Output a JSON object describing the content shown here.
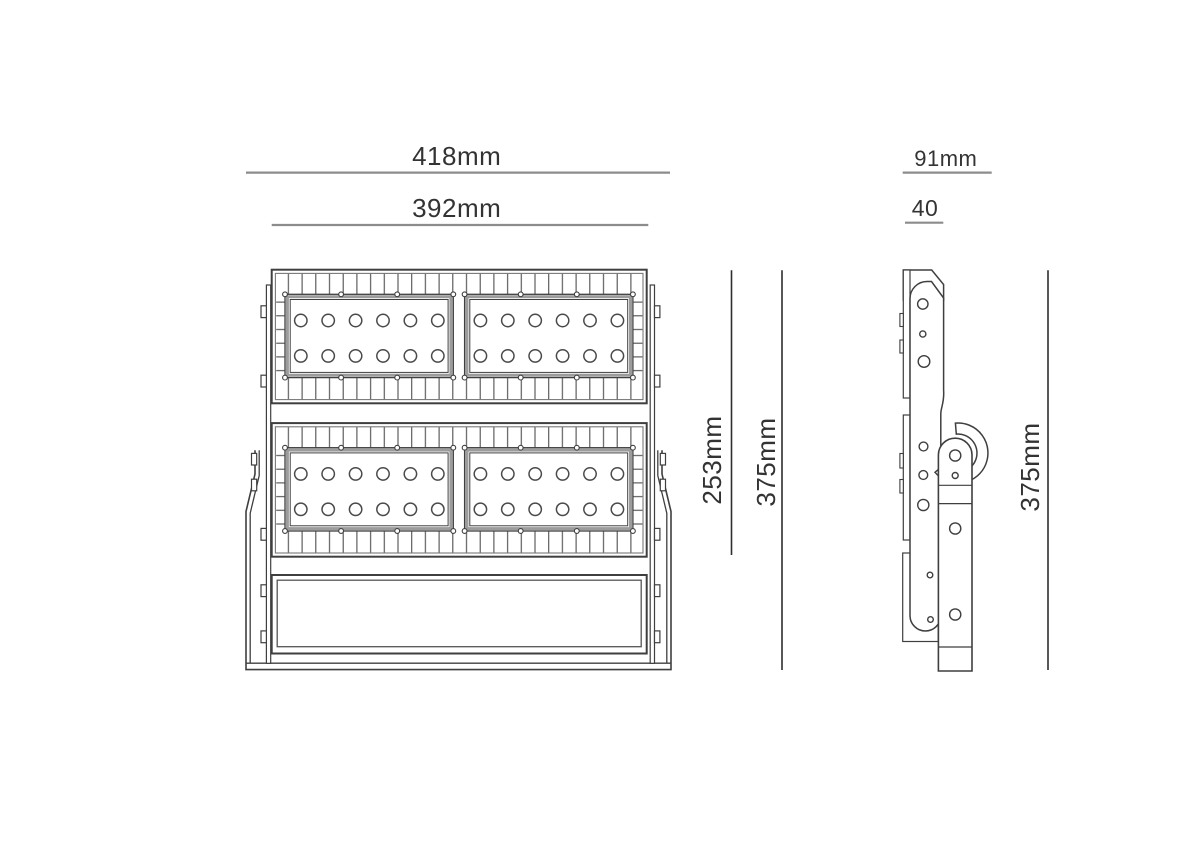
{
  "page": {
    "background": "#ffffff",
    "description": "Technical dimension drawing of an LED flood light shown in front view and side view"
  },
  "front_view": {
    "name": "front-view",
    "dimension_labels": {
      "overall_width": "418mm",
      "body_width": "392mm",
      "led_section_height": "253mm",
      "overall_height": "375mm"
    },
    "led_module_rows": 2,
    "panels_per_row": 2,
    "led_rows_per_panel": 2,
    "led_columns_per_panel": 6,
    "leds_per_panel": 12,
    "has_mounting_yoke": true,
    "has_driver_box": true
  },
  "side_view": {
    "name": "side-view",
    "dimension_labels": {
      "overall_depth": "91mm",
      "body_depth": "40",
      "overall_height": "375mm"
    },
    "has_mounting_bracket_arm": true
  },
  "colors": {
    "outline": "#3f3f3f",
    "fin_line": "#4f4f4f",
    "frame_band": "#9c9c9c",
    "dimension_line_horizontal": "#8c8c8c",
    "dimension_line_vertical": "#2e2e2e",
    "label_text": "#333333"
  }
}
